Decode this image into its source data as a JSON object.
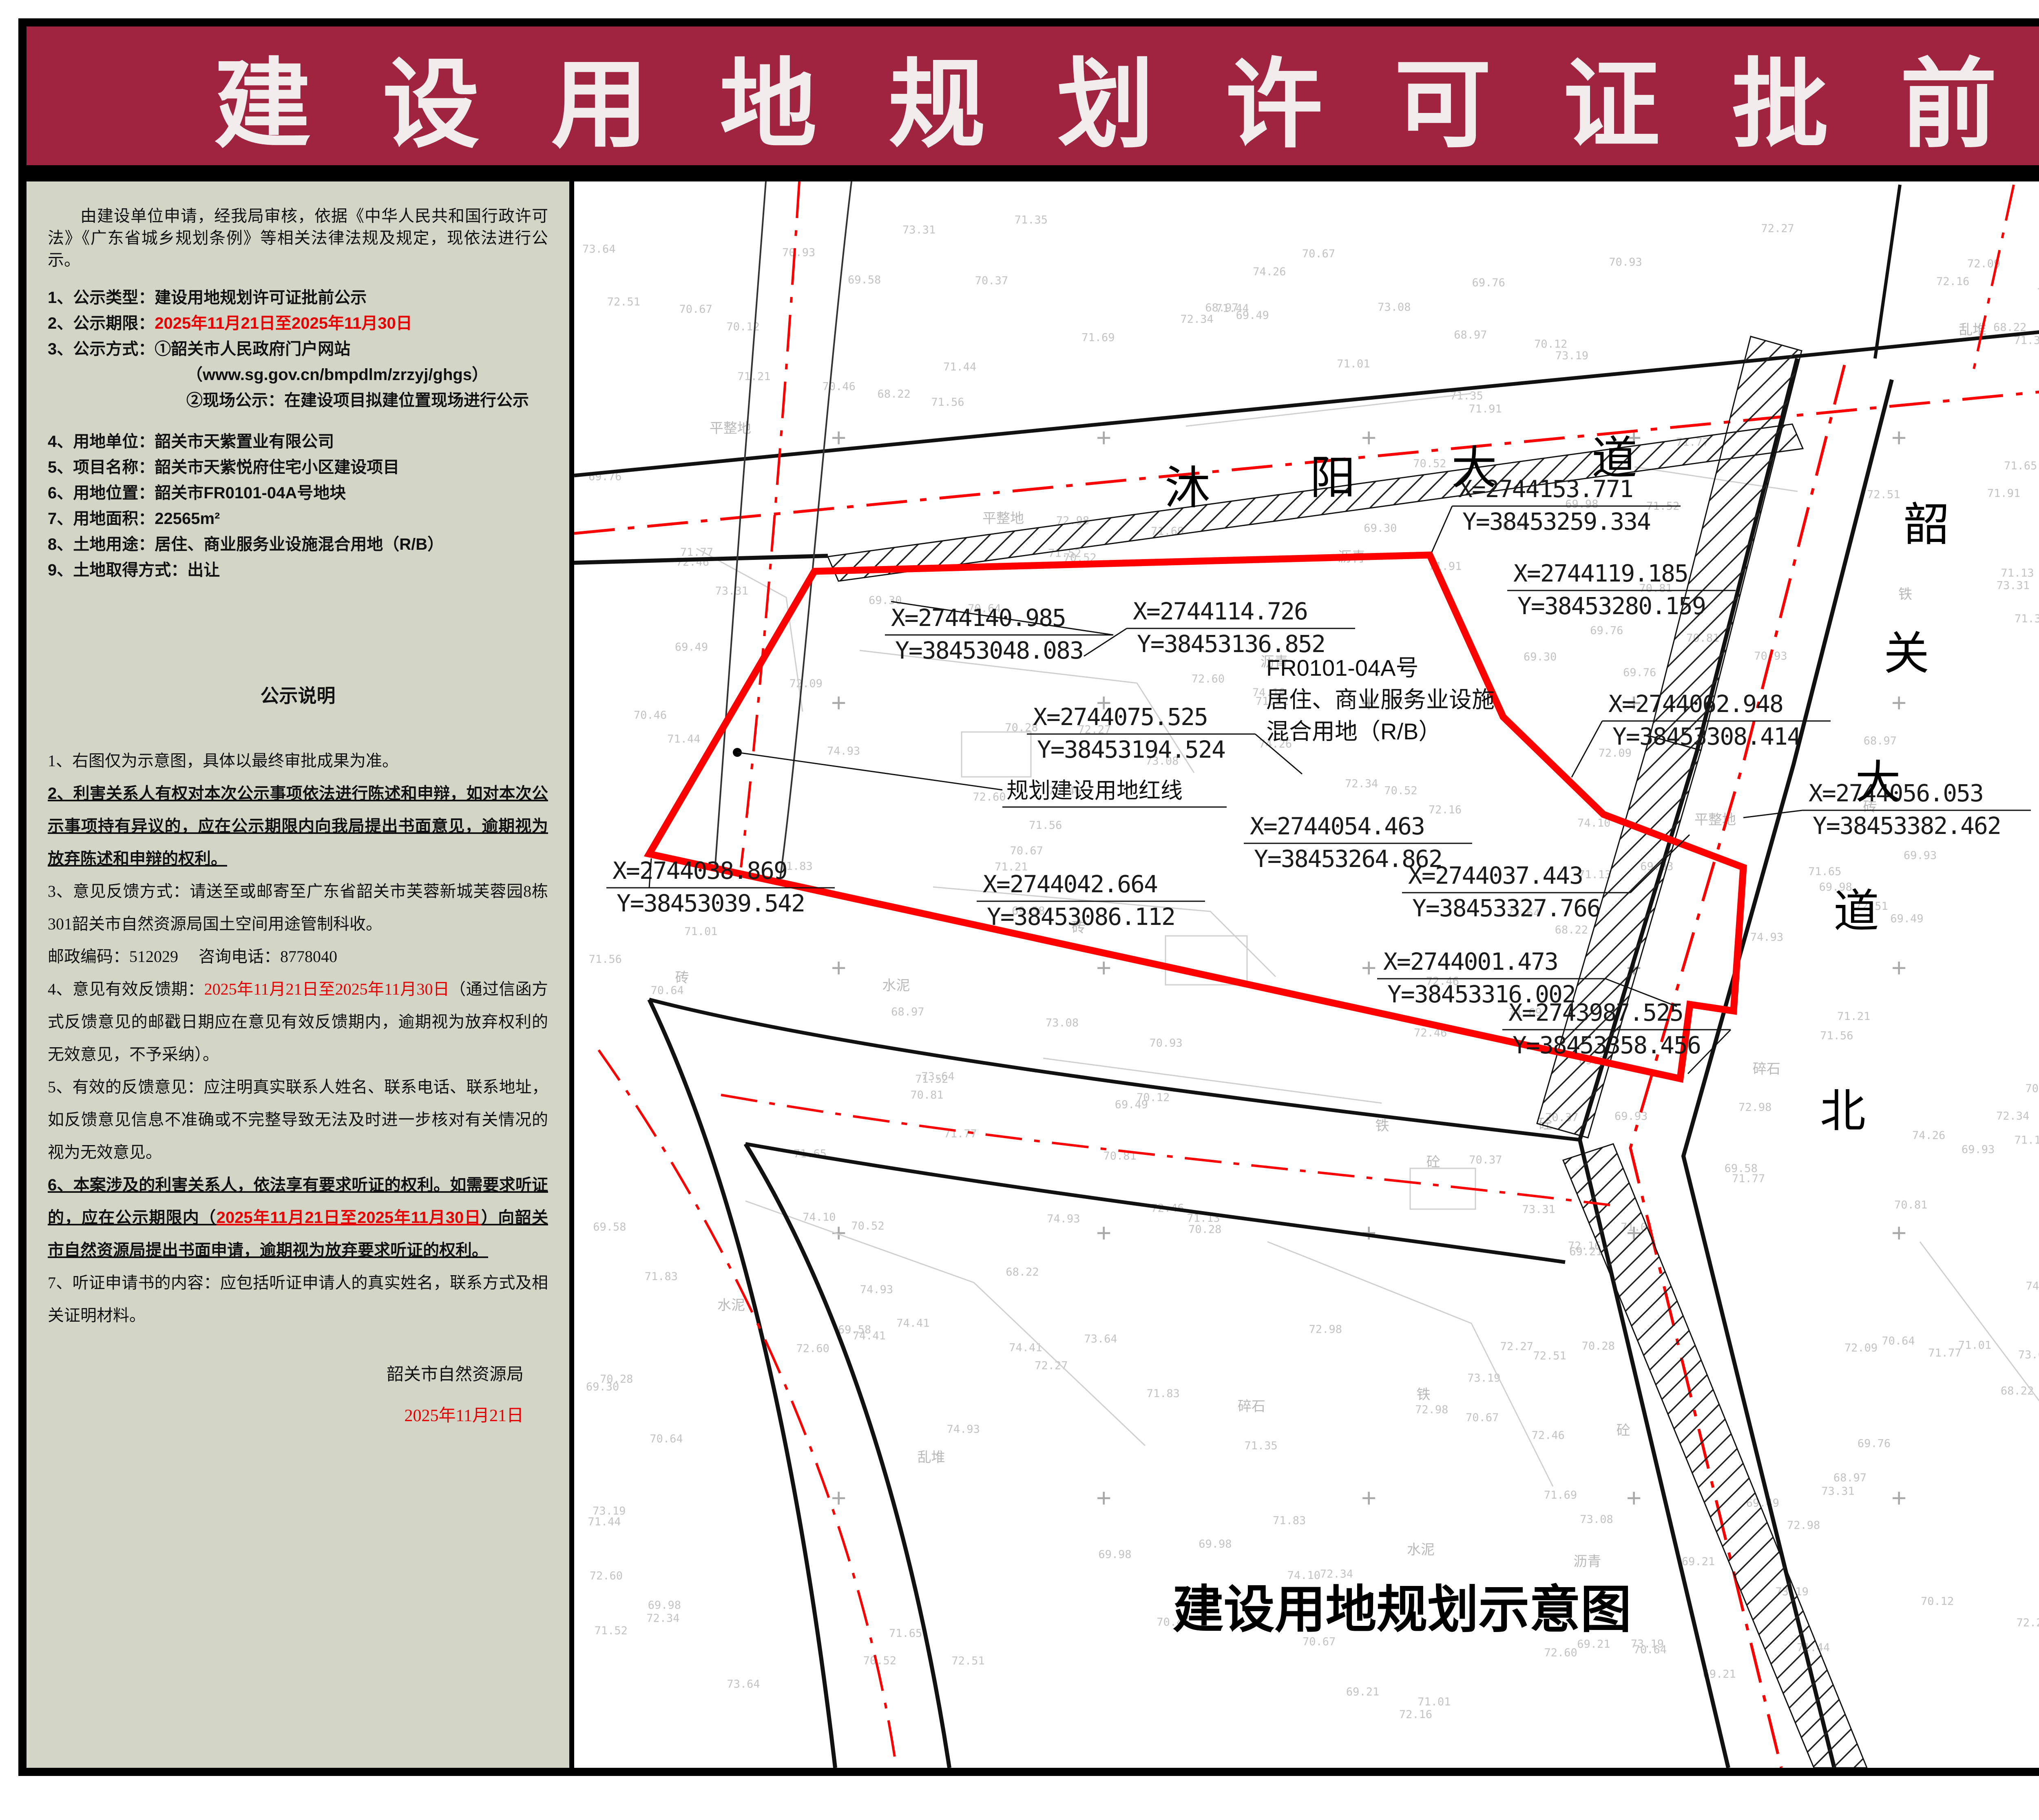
{
  "banner": {
    "title": "建 设 用 地 规 划 许 可 证 批 前 公 示"
  },
  "notice": {
    "intro": "由建设单位申请，经我局审核，依据《中华人民共和国行政许可法》《广东省城乡规划条例》等相关法律法规及规定，现依法进行公示。",
    "items": [
      {
        "label": "1、公示类型：",
        "value": "建设用地规划许可证批前公示"
      },
      {
        "label": "2、公示期限：",
        "value": "2025年11月21日至2025年11月30日"
      },
      {
        "label": "3、公示方式：",
        "value": "①韶关市人民政府门户网站"
      },
      {
        "sub1": "（www.sg.gov.cn/bmpdlm/zrzyj/ghgs）",
        "sub2": "②现场公示：在建设项目拟建位置现场进行公示"
      },
      {
        "label": "4、用地单位：",
        "value": "韶关市天紫置业有限公司"
      },
      {
        "label": "5、项目名称：",
        "value": "韶关市天紫悦府住宅小区建设项目"
      },
      {
        "label": "6、用地位置：",
        "value": "韶关市FR0101-04A号地块"
      },
      {
        "label": "7、用地面积：",
        "value": "22565m²"
      },
      {
        "label": "8、土地用途：",
        "value": "居住、商业服务业设施混合用地（R/B）"
      },
      {
        "label": "9、土地取得方式：",
        "value": "出让"
      }
    ],
    "statement_title": "公示说明",
    "statements": [
      {
        "parts": [
          {
            "t": "1、右图仅为示意图，具体以最终审批成果为准。"
          }
        ]
      },
      {
        "parts": [
          {
            "t": "2、利害关系人有权对本次公示事项依法进行陈述和申辩，如对本次公示事项持有异议的，应在公示期限内向我局提出书面意见，逾期视为放弃陈述和申辩的权利。"
          }
        ]
      },
      {
        "parts": [
          {
            "t": "3、意见反馈方式：请送至或邮寄至广东省韶关市芙蓉新城芙蓉园8栋301韶关市自然资源局国土空间用途管制科收。"
          }
        ]
      },
      {
        "parts": [
          {
            "t": "邮政编码：512029　 咨询电话：8778040"
          }
        ]
      },
      {
        "parts": [
          {
            "t": "4、意见有效反馈期："
          },
          {
            "t": "2025年11月21日至2025年11月30日"
          },
          {
            "t": "（通过信函方式反馈意见的邮戳日期应在意见有效反馈期内，逾期视为放弃权利的无效意见，不予采纳）。"
          }
        ]
      },
      {
        "parts": [
          {
            "t": "5、有效的反馈意见：应注明真实联系人姓名、联系电话、联系地址，如反馈意见信息不准确或不完整导致无法及时进一步核对有关情况的视为无效意见。"
          }
        ]
      },
      {
        "parts": [
          {
            "t": "6、本案涉及的利害关系人，依法享有要求听证的权利。如需要求听证的，应在公示期限内（"
          },
          {
            "t": "2025年11月21日至2025年11月30日"
          },
          {
            "t": "）向韶关市自然资源局提出书面申请，逾期视为放弃要求听证的权利。"
          }
        ]
      },
      {
        "parts": [
          {
            "t": "7、听证申请书的内容：应包括听证申请人的真实姓名，联系方式及相关证明材料。"
          }
        ]
      }
    ],
    "signature": "韶关市自然资源局",
    "signature_date": "2025年11月21日"
  },
  "map": {
    "caption": "建设用地规划示意图",
    "parcel_label": [
      "FR0101-04A号",
      "居住、商业服务业设施",
      "混合用地（R/B）"
    ],
    "redline_label": "规划建设用地红线",
    "road_muyang_chars": [
      "沐",
      "阳",
      "大",
      "道"
    ],
    "road_shaoguan_chars": [
      "韶",
      "关",
      "大",
      "道",
      "北"
    ],
    "coordinate_labels": [
      {
        "x": "X=2744153.771",
        "y": "Y=38453259.334"
      },
      {
        "x": "X=2744119.185",
        "y": "Y=38453280.159"
      },
      {
        "x": "X=2744140.985",
        "y": "Y=38453048.083"
      },
      {
        "x": "X=2744114.726",
        "y": "Y=38453136.852"
      },
      {
        "x": "X=2744062.948",
        "y": "Y=38453308.414"
      },
      {
        "x": "X=2744075.525",
        "y": "Y=38453194.524"
      },
      {
        "x": "X=2744056.053",
        "y": "Y=38453382.462"
      },
      {
        "x": "X=2744054.463",
        "y": "Y=38453264.862"
      },
      {
        "x": "X=2744038.869",
        "y": "Y=38453039.542"
      },
      {
        "x": "X=2744042.664",
        "y": "Y=38453086.112"
      },
      {
        "x": "X=2744037.443",
        "y": "Y=38453327.766"
      },
      {
        "x": "X=2744001.473",
        "y": "Y=38453316.002"
      },
      {
        "x": "X=2743987.525",
        "y": "Y=38453358.456"
      }
    ],
    "topo_values": [
      "71.52",
      "72.34",
      "71.44",
      "70.81",
      "69.93",
      "72.46",
      "71.69",
      "70.52",
      "71.13",
      "72.09",
      "70.37",
      "71.21",
      "69.98",
      "72.27",
      "70.67",
      "71.35",
      "68.22",
      "69.49",
      "73.08",
      "71.91",
      "70.12",
      "72.60",
      "69.76",
      "71.56",
      "74.26",
      "73.19",
      "70.64",
      "71.83",
      "72.98",
      "69.21",
      "74.93",
      "73.64",
      "71.01",
      "72.16",
      "70.46",
      "69.58",
      "73.31",
      "74.41",
      "68.97",
      "70.93",
      "71.77",
      "72.51",
      "69.30",
      "74.10",
      "70.28",
      "71.65"
    ],
    "surface_labels": [
      "水泥",
      "沥青",
      "平整地",
      "铁",
      "砖",
      "砼",
      "乱堆",
      "碎石"
    ]
  },
  "sidebar": {
    "compass_label": "N",
    "legend_title": "图例",
    "legend_item_label": "规划建设用地红线",
    "location_title": "位置示意图",
    "location_map": {
      "parcel_label": "地块位置",
      "railway_chars": [
        "京",
        "广",
        "高",
        "速",
        "铁"
      ],
      "road_muyang_chars": [
        "沐",
        "阳",
        "大",
        "道"
      ],
      "road_shaoguan_chars": [
        "韶",
        "关",
        "大",
        "道"
      ]
    }
  },
  "footer": {
    "supervisor": "监制单位：韶关市自然资源局"
  },
  "colors": {
    "banner_bg": "#a02340",
    "panel_bg": "#d3d6c7",
    "redline": "#ff0000",
    "date_red": "#e60000"
  }
}
